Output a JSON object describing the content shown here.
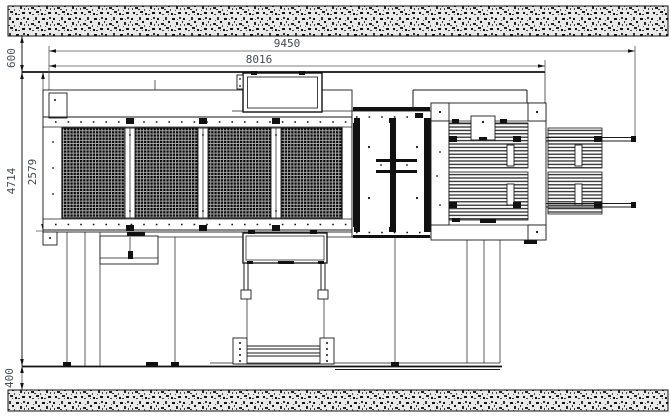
{
  "drawing": {
    "kind": "machine-layout-top-view",
    "line_color": "#1a1a1a",
    "dim_text_color": "#454c54",
    "wall_hatch": "concrete-stipple",
    "dimensions": {
      "overall_length": "9450",
      "frame_length": "8016",
      "top_clearance": "600",
      "overall_width": "4714",
      "screen_width": "2579",
      "bottom_clearance": "400"
    }
  }
}
